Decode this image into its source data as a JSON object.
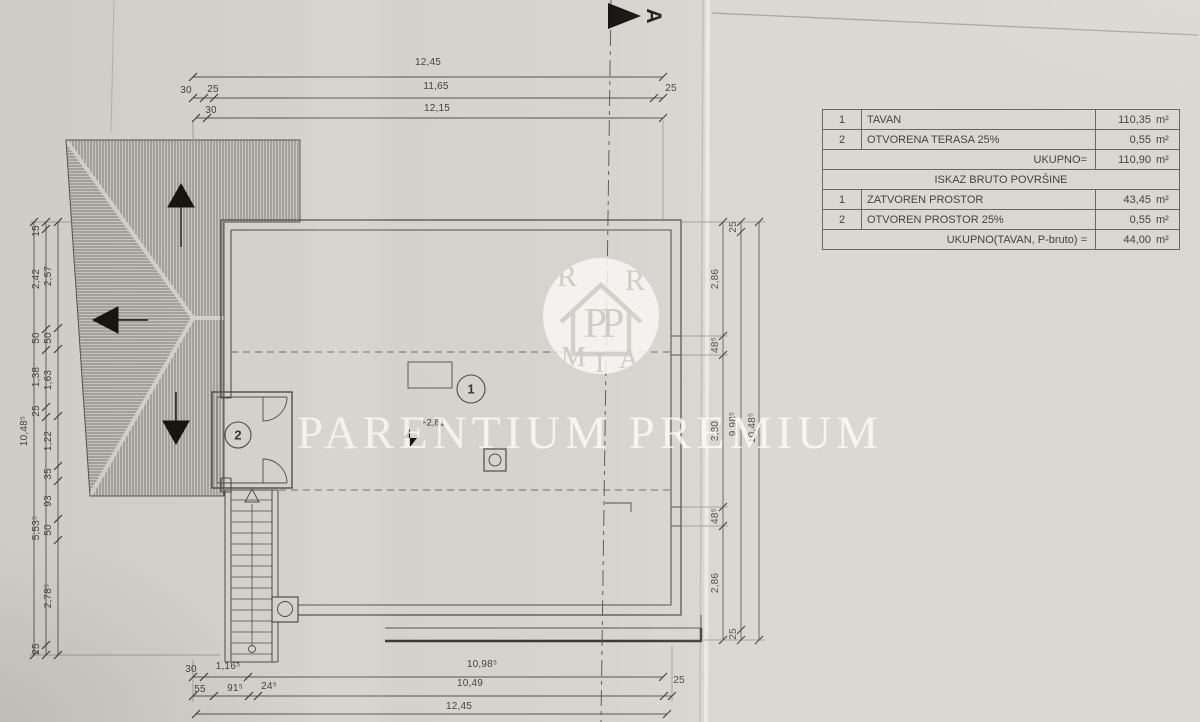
{
  "section": {
    "marker": "A"
  },
  "watermark": {
    "text": "PARENTIUM PREMIUM",
    "logo_monogram": "PP",
    "logo_ring": [
      "R",
      "R",
      "M",
      "I",
      "A"
    ]
  },
  "plan": {
    "room1_label": "1",
    "room2_label": "2",
    "level_mark": "+2,81"
  },
  "table": {
    "rows": [
      {
        "num": "1",
        "label": "TAVAN",
        "value": "110,35",
        "unit": "m²"
      },
      {
        "num": "2",
        "label": "OTVORENA TERASA 25%",
        "value": "0,55",
        "unit": "m²"
      },
      {
        "num": "",
        "label": "UKUPNO=",
        "value": "110,90",
        "unit": "m²"
      },
      {
        "num": "",
        "label": "ISKAZ BRUTO POVRŠINE",
        "value": "",
        "unit": ""
      },
      {
        "num": "1",
        "label": "ZATVOREN PROSTOR",
        "value": "43,45",
        "unit": "m²"
      },
      {
        "num": "2",
        "label": "OTVOREN PROSTOR 25%",
        "value": "0,55",
        "unit": "m²"
      },
      {
        "num": "",
        "label": "UKUPNO(TAVAN, P-bruto) =",
        "value": "44,00",
        "unit": "m²"
      }
    ]
  },
  "dims": {
    "top": {
      "total": "12,45",
      "row2": [
        "30",
        "25",
        "11,65",
        "25"
      ],
      "row3": [
        "30",
        "12,15"
      ]
    },
    "bottom": {
      "row1": [
        "30",
        "1,16⁵",
        "10,98⁵"
      ],
      "row2": [
        "55",
        "91⁵",
        "24⁵",
        "10,49",
        "25"
      ],
      "total": "12,45"
    },
    "left": {
      "total": "10,48⁵",
      "mid": [
        "15",
        "2,42",
        "50",
        "1,38",
        "25",
        "5,53⁵",
        "25"
      ],
      "inner": [
        "2,57",
        "50",
        "1,63",
        "1,22",
        "35",
        "93",
        "50",
        "2,78⁵"
      ]
    },
    "right": {
      "total": "10,48⁵",
      "mid": [
        "25",
        "9,98⁵",
        "25"
      ],
      "inner": [
        "2,86",
        "48⁵",
        "3,80",
        "48⁵",
        "2,86"
      ]
    }
  }
}
